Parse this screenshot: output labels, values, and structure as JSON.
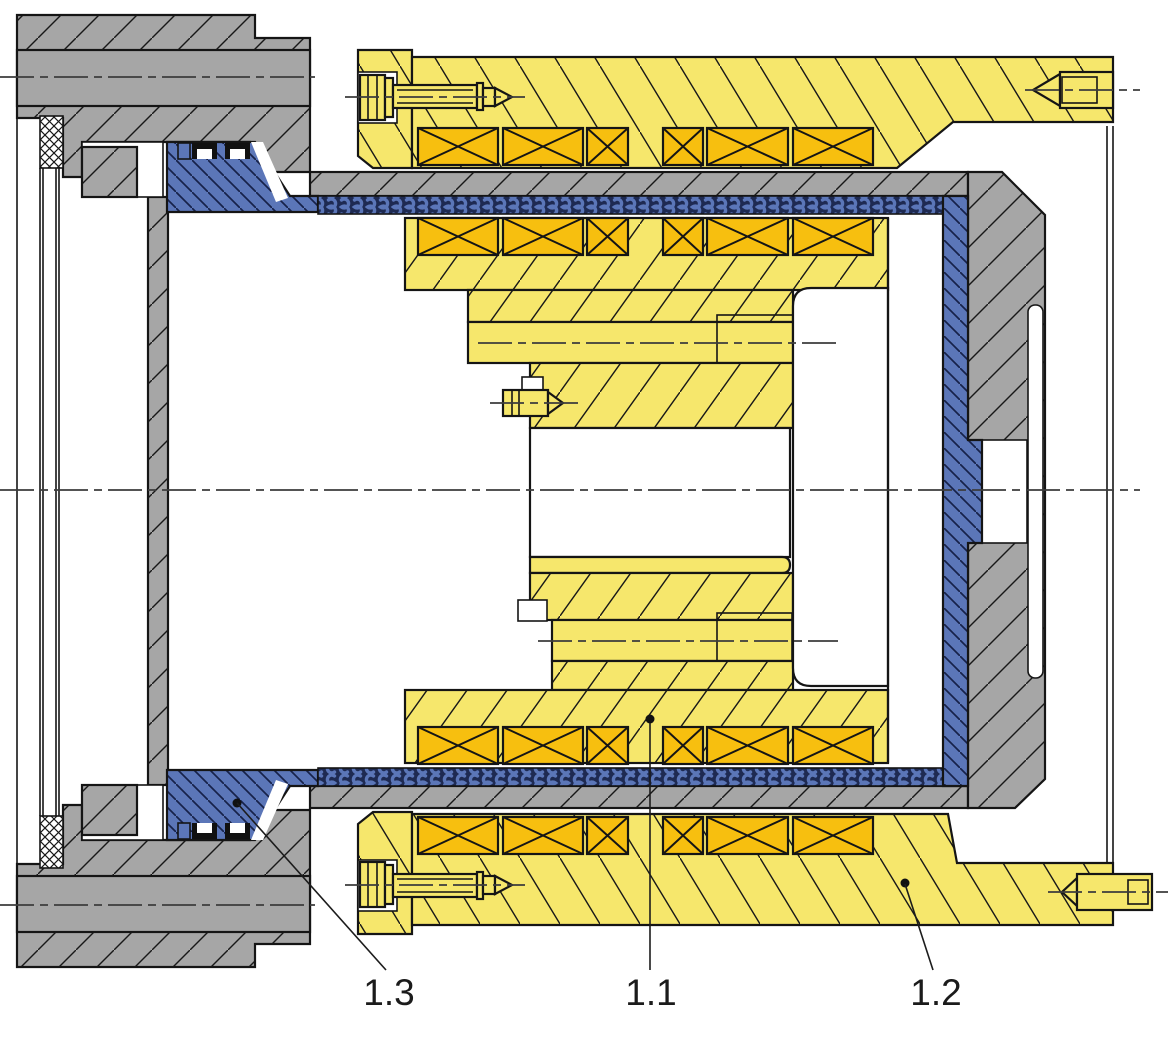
{
  "labels": [
    {
      "id": "1.1",
      "text": "1.1"
    },
    {
      "id": "1.2",
      "text": "1.2"
    },
    {
      "id": "1.3",
      "text": "1.3"
    }
  ],
  "colors": {
    "c-yellow": "#f6e76c",
    "c-coil": "#f7bf0f",
    "c-gray": "#a6a6a6",
    "c-blue": "#5b76b8",
    "c-teeth": "#1e2a52",
    "c-line": "#151515"
  }
}
